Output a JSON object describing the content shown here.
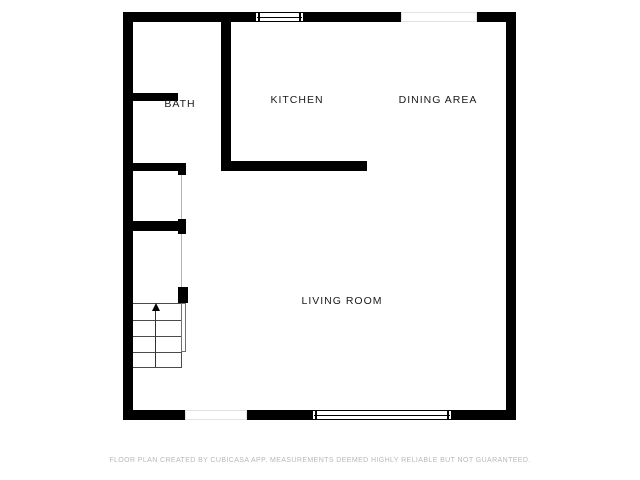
{
  "floor_plan": {
    "rooms": [
      {
        "label": "BATH"
      },
      {
        "label": "KITCHEN"
      },
      {
        "label": "DINING AREA"
      },
      {
        "label": "LIVING ROOM"
      }
    ],
    "features": {
      "stairs_direction": "up",
      "windows": [
        "top wall window",
        "bottom wall window"
      ],
      "openings": [
        "top wall opening",
        "bottom wall doorway",
        "bath doorway",
        "hallway openings"
      ]
    },
    "footer": {
      "disclaimer": "FLOOR PLAN CREATED BY CUBICASA APP. MEASUREMENTS DEEMED HIGHLY RELIABLE BUT NOT GUARANTEED."
    },
    "colors": {
      "wall": "#000000",
      "background": "#ffffff",
      "label_text": "#1a1a1a",
      "footer_text": "#b8b8b8",
      "stair_lines": "#4a4a4a",
      "opening_border": "#e2e2e2"
    }
  }
}
